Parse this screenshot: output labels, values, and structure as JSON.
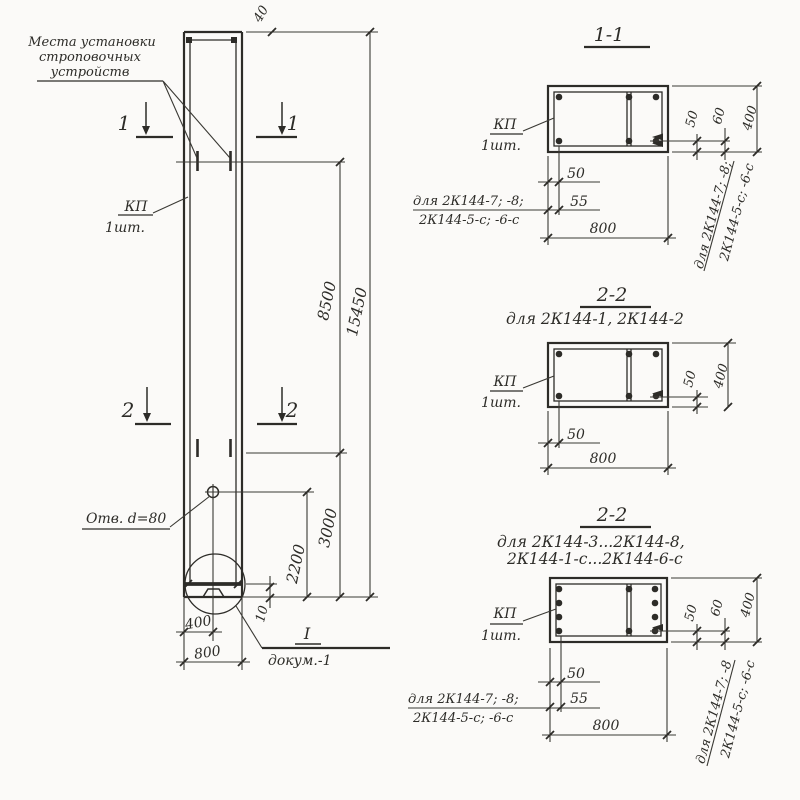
{
  "palette": {
    "paper": "#fbfaf8",
    "ink": "#2d2c28"
  },
  "elevation": {
    "strop_note_l1": "Места установки",
    "strop_note_l2": "строповочных",
    "strop_note_l3": "устройств",
    "mark1": "1",
    "mark2": "2",
    "part": "КП",
    "qty": "1шт.",
    "dim_40": "40",
    "dim_15450": "15450",
    "dim_8500": "8500",
    "dim_3000": "3000",
    "dim_2200": "2200",
    "hole_note": "Отв. d=80",
    "dim_10": "10",
    "dim_400": "400",
    "dim_800": "800",
    "detail_ref": "I",
    "detail_doc": "докум.-1"
  },
  "section11": {
    "title": "1-1",
    "part": "КП",
    "qty": "1шт.",
    "dim_50": "50",
    "dim_55": "55",
    "dim_800": "800",
    "dim_r50": "50",
    "dim_r60": "60",
    "dim_r400": "400",
    "note_l1": "для 2К144-7; -8;",
    "note_l2": "2К144-5-с; -6-с",
    "vnote_l1": "для 2К144-7; -8;",
    "vnote_l2": "2К144-5-с; -6-с"
  },
  "section22a": {
    "title": "2-2",
    "subtitle": "для 2К144-1, 2К144-2",
    "part": "КП",
    "qty": "1шт.",
    "dim_50": "50",
    "dim_800": "800",
    "dim_r50": "50",
    "dim_r400": "400"
  },
  "section22b": {
    "title": "2-2",
    "subtitle1": "для 2К144-3...2К144-8,",
    "subtitle2": "2К144-1-с...2К144-6-с",
    "part": "КП",
    "qty": "1шт.",
    "dim_50": "50",
    "dim_55": "55",
    "dim_800": "800",
    "dim_r50": "50",
    "dim_r60": "60",
    "dim_r400": "400",
    "note_l1": "для 2К144-7; -8;",
    "note_l2": "2К144-5-с; -6-с",
    "vnote_l1": "для 2К144-7; -8",
    "vnote_l2": "2К144-5-с; -6-с"
  }
}
